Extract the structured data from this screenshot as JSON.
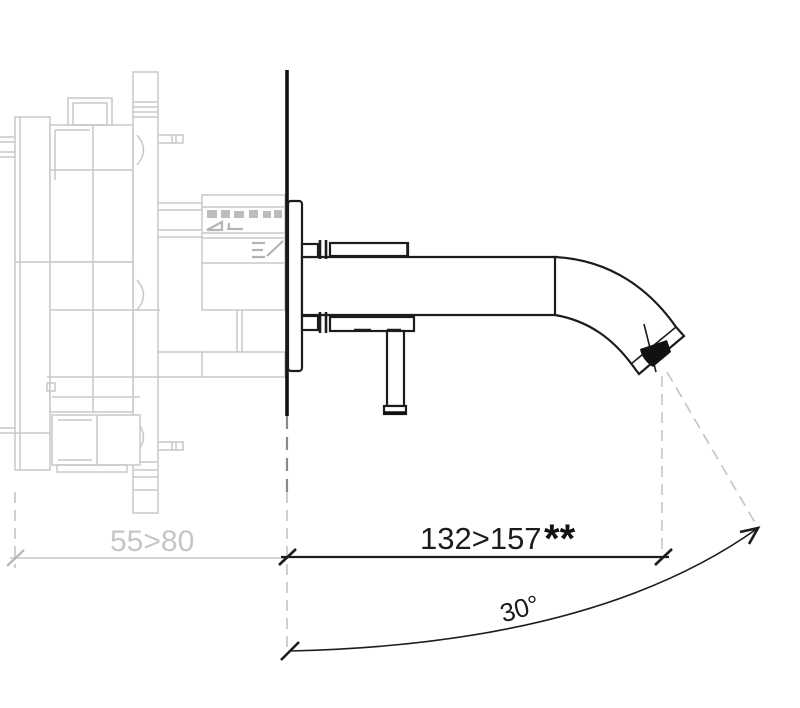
{
  "figure": {
    "type": "technical-drawing",
    "subject": "wall-mounted-basin-mixer-side-view",
    "labels": {
      "depth_range": "55>80",
      "reach_range": "132>157",
      "reach_note": "**",
      "spray_angle": "30°"
    },
    "colors": {
      "ink": "#1c1c1c",
      "ghost_gray": "#c8c8c8",
      "background": "#ffffff"
    }
  }
}
